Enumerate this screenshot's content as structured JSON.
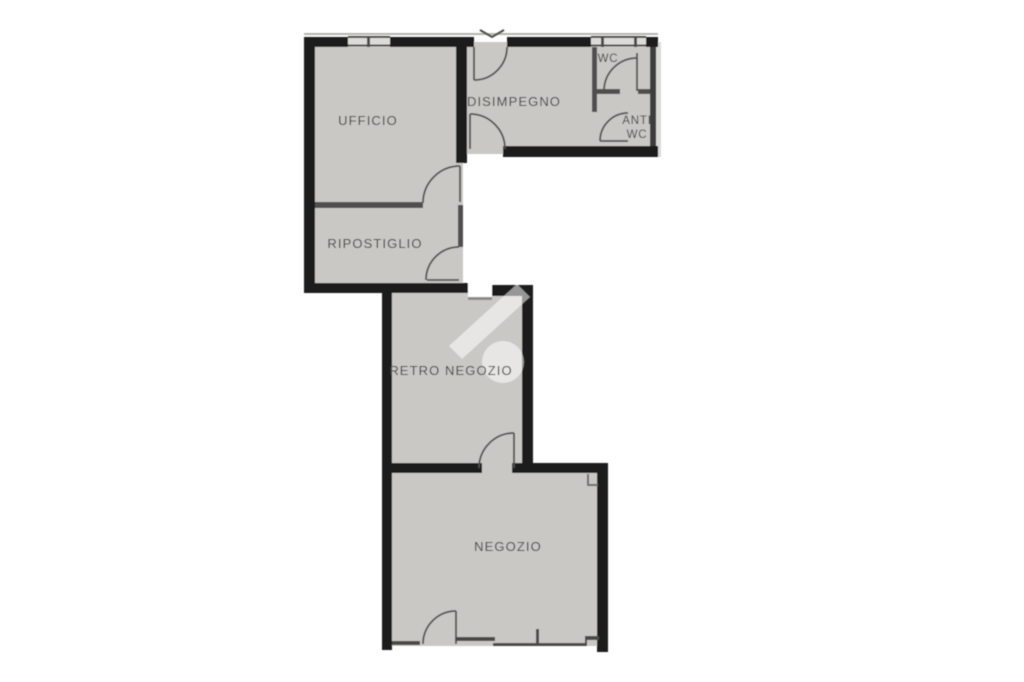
{
  "colors": {
    "background": "#ffffff",
    "floor": "#c9c8c4",
    "wall": "#1a1a1a",
    "line": "#4f4f4f",
    "label": "#3e3e3e",
    "watermark": "#ffffff"
  },
  "rooms": {
    "ufficio": {
      "label": "UFFICIO"
    },
    "disimpegno": {
      "label": "DISIMPEGNO"
    },
    "wc": {
      "label": "WC"
    },
    "anti_wc": {
      "label_line1": "ANTI",
      "label_line2": "WC"
    },
    "ripostiglio": {
      "label": "RIPOSTIGLIO"
    },
    "retro_negozio": {
      "label": "RETRO NEGOZIO"
    },
    "negozio": {
      "label": "NEGOZIO"
    }
  }
}
